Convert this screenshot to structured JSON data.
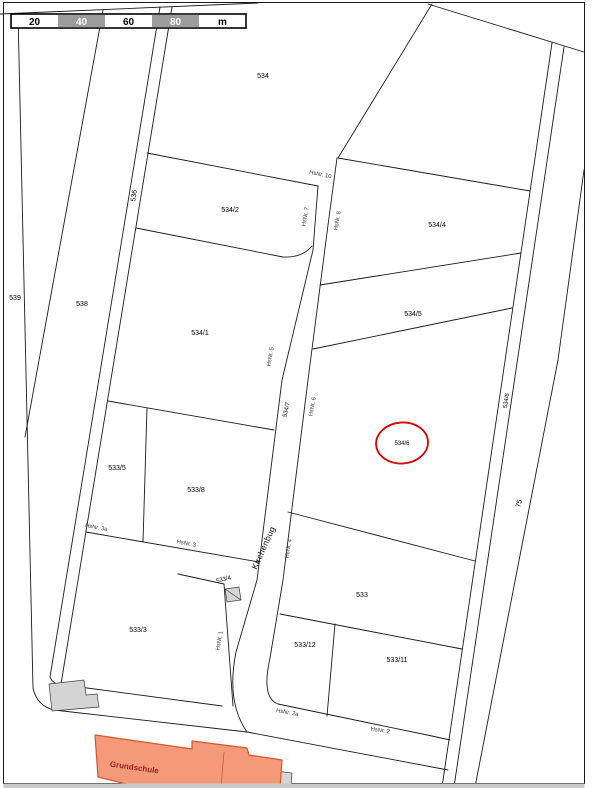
{
  "scale_bar": {
    "labels": [
      "20",
      "40",
      "60",
      "80",
      "m"
    ],
    "gray_color": "#9c9c9c"
  },
  "street": {
    "name": "Kirchenbug"
  },
  "parcels": {
    "p534": "534",
    "p534_1": "534/1",
    "p534_2": "534/2",
    "p534_4": "534/4",
    "p534_5": "534/5",
    "p534_6": "534/6",
    "p534_7": "534/7",
    "p534_8": "534/8",
    "p533": "533",
    "p533_3": "533/3",
    "p533_4": "533/4",
    "p533_5": "533/5",
    "p533_8": "533/8",
    "p533_11": "533/11",
    "p533_12": "533/12",
    "p536": "536",
    "p538": "538",
    "p539": "539",
    "p75": "75"
  },
  "house_numbers": {
    "h1": "HsNr. 1",
    "h2": "HsNr. 2",
    "h2a": "HsNr. 2a",
    "h3": "HsNr. 3",
    "h3a": "HsNr. 3a",
    "h4": "HsNr. 4",
    "h5": "HsNr. 5",
    "h6": "HsNr. 6",
    "h7": "HsNr. 7",
    "h8": "HsNr. 8",
    "h10": "HsNr. 10"
  },
  "buildings": {
    "school_label": "Grundschule"
  },
  "highlight": {
    "parcel": "534/6",
    "color": "#dd0000"
  },
  "colors": {
    "school_fill": "#f49a7a",
    "school_stroke": "#d4562e",
    "school_text": "#9b1c1c",
    "building_gray": "#d4d4d4",
    "scale_gray": "#9c9c9c",
    "bottom_strip": "#c9c9c9",
    "line": "#1a1a1a"
  }
}
